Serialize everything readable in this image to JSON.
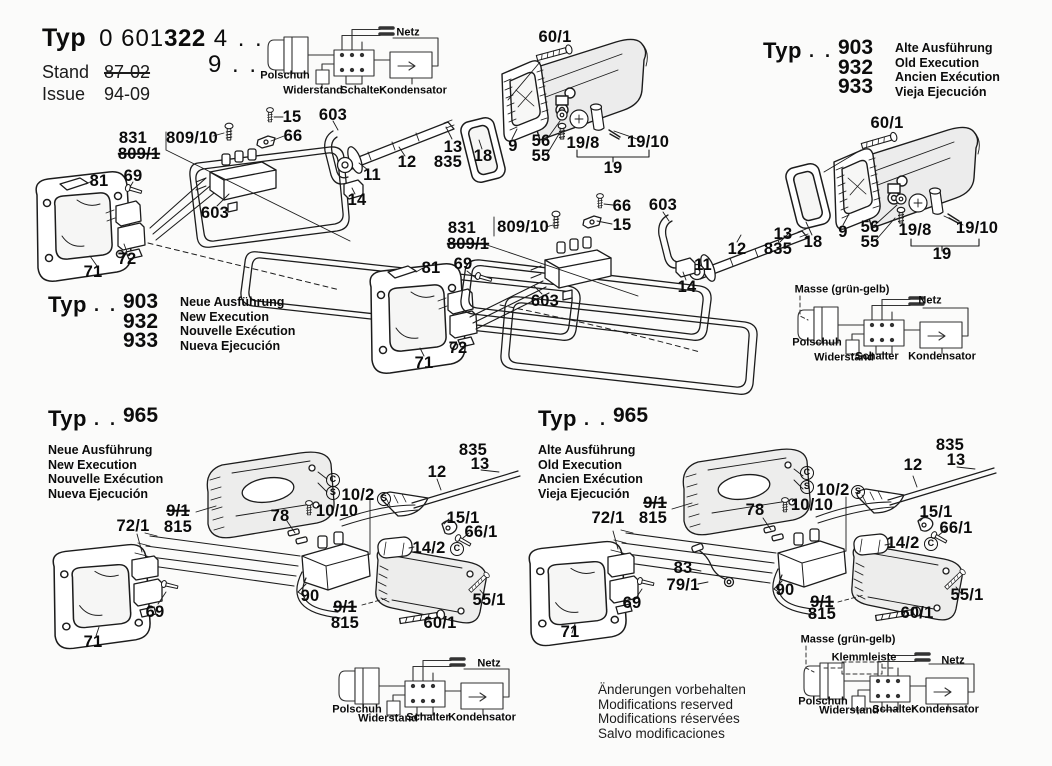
{
  "header": {
    "typ_label": "Typ",
    "code_prefix": "0 601",
    "code_bold": "322",
    "code_suffix": "4 . .",
    "code_line2": "9 . .",
    "stand_label": "Stand",
    "stand_value": "87-02",
    "issue_label": "Issue",
    "issue_value": "94-09"
  },
  "type_blocks": [
    {
      "x": 763,
      "y": 38,
      "typ": "Typ",
      "dots": ". .",
      "numbers": [
        "903",
        "932",
        "933"
      ],
      "langs": [
        "Alte Ausführung",
        "Old Execution",
        "Ancien Exécution",
        "Vieja Ejecución"
      ]
    },
    {
      "x": 48,
      "y": 292,
      "typ": "Typ",
      "dots": ". .",
      "numbers": [
        "903",
        "932",
        "933"
      ],
      "langs": [
        "Neue Ausführung",
        "New Execution",
        "Nouvelle Exécution",
        "Nueva Ejecución"
      ]
    },
    {
      "x": 48,
      "y": 406,
      "typ": "Typ",
      "dots": ". .",
      "numbers": [
        "965"
      ],
      "langs": [
        "Neue Ausführung",
        "New Execution",
        "Nouvelle Exécution",
        "Nueva Ejecución"
      ]
    },
    {
      "x": 538,
      "y": 406,
      "typ": "Typ",
      "dots": ". .",
      "numbers": [
        "965"
      ],
      "langs": [
        "Alte Ausführung",
        "Old Execution",
        "Ancien Exécution",
        "Vieja Ejecución"
      ]
    }
  ],
  "parts": {
    "top_left_assembly": [
      {
        "t": "831",
        "x": 133,
        "y": 138
      },
      {
        "t": "809/1",
        "x": 139,
        "y": 154,
        "k": "strike"
      },
      {
        "t": "809/10",
        "x": 192,
        "y": 138
      },
      {
        "t": "15",
        "x": 292,
        "y": 117
      },
      {
        "t": "66",
        "x": 293,
        "y": 136
      },
      {
        "t": "603",
        "x": 333,
        "y": 115
      },
      {
        "t": "81",
        "x": 99,
        "y": 181
      },
      {
        "t": "69",
        "x": 133,
        "y": 176
      },
      {
        "t": "603",
        "x": 215,
        "y": 213
      },
      {
        "t": "71",
        "x": 93,
        "y": 272
      },
      {
        "t": "72",
        "x": 127,
        "y": 259
      },
      {
        "t": "11",
        "x": 372,
        "y": 175
      },
      {
        "t": "14",
        "x": 357,
        "y": 200
      },
      {
        "t": "12",
        "x": 407,
        "y": 162
      },
      {
        "t": "13",
        "x": 453,
        "y": 147
      },
      {
        "t": "835",
        "x": 448,
        "y": 162
      },
      {
        "t": "18",
        "x": 483,
        "y": 156
      },
      {
        "t": "9",
        "x": 513,
        "y": 146
      },
      {
        "t": "56",
        "x": 541,
        "y": 141
      },
      {
        "t": "55",
        "x": 541,
        "y": 156
      },
      {
        "t": "19/8",
        "x": 583,
        "y": 143
      },
      {
        "t": "19/10",
        "x": 648,
        "y": 142
      },
      {
        "t": "19",
        "x": 613,
        "y": 168
      },
      {
        "t": "60/1",
        "x": 555,
        "y": 37
      }
    ],
    "top_right_assembly": [
      {
        "t": "60/1",
        "x": 887,
        "y": 123
      },
      {
        "t": "11",
        "x": 703,
        "y": 265
      },
      {
        "t": "12",
        "x": 737,
        "y": 249
      },
      {
        "t": "13",
        "x": 783,
        "y": 234
      },
      {
        "t": "835",
        "x": 778,
        "y": 249
      },
      {
        "t": "18",
        "x": 813,
        "y": 242
      },
      {
        "t": "9",
        "x": 843,
        "y": 232
      },
      {
        "t": "56",
        "x": 870,
        "y": 227
      },
      {
        "t": "55",
        "x": 870,
        "y": 242
      },
      {
        "t": "19/8",
        "x": 915,
        "y": 230
      },
      {
        "t": "19/10",
        "x": 977,
        "y": 228
      },
      {
        "t": "19",
        "x": 942,
        "y": 254
      }
    ],
    "middle_assembly": [
      {
        "t": "831",
        "x": 462,
        "y": 228
      },
      {
        "t": "809/1",
        "x": 468,
        "y": 244,
        "k": "strike"
      },
      {
        "t": "809/10",
        "x": 523,
        "y": 227
      },
      {
        "t": "66",
        "x": 622,
        "y": 206
      },
      {
        "t": "15",
        "x": 622,
        "y": 225
      },
      {
        "t": "603",
        "x": 663,
        "y": 205
      },
      {
        "t": "81",
        "x": 431,
        "y": 268
      },
      {
        "t": "69",
        "x": 463,
        "y": 264
      },
      {
        "t": "603",
        "x": 545,
        "y": 301
      },
      {
        "t": "14",
        "x": 687,
        "y": 287
      },
      {
        "t": "72",
        "x": 458,
        "y": 348
      },
      {
        "t": "71",
        "x": 424,
        "y": 363
      }
    ],
    "bottom_left_assembly": [
      {
        "t": "835",
        "x": 473,
        "y": 450
      },
      {
        "t": "13",
        "x": 480,
        "y": 464
      },
      {
        "t": "12",
        "x": 437,
        "y": 472
      },
      {
        "t": "C",
        "x": 333,
        "y": 480,
        "k": "circ"
      },
      {
        "t": "S",
        "x": 333,
        "y": 493,
        "k": "circ"
      },
      {
        "t": "10/2",
        "x": 358,
        "y": 495
      },
      {
        "t": "S",
        "x": 384,
        "y": 499,
        "k": "circ"
      },
      {
        "t": "10/10",
        "x": 337,
        "y": 511
      },
      {
        "t": "9/1",
        "x": 178,
        "y": 511,
        "k": "strike"
      },
      {
        "t": "815",
        "x": 178,
        "y": 527
      },
      {
        "t": "78",
        "x": 280,
        "y": 516
      },
      {
        "t": "72/1",
        "x": 133,
        "y": 526
      },
      {
        "t": "15/1",
        "x": 463,
        "y": 518
      },
      {
        "t": "66/1",
        "x": 481,
        "y": 532
      },
      {
        "t": "14/2",
        "x": 429,
        "y": 548
      },
      {
        "t": "C",
        "x": 457,
        "y": 549,
        "k": "circ"
      },
      {
        "t": "90",
        "x": 310,
        "y": 596
      },
      {
        "t": "9/1",
        "x": 345,
        "y": 607,
        "k": "strike"
      },
      {
        "t": "815",
        "x": 345,
        "y": 623
      },
      {
        "t": "60/1",
        "x": 440,
        "y": 623
      },
      {
        "t": "55/1",
        "x": 489,
        "y": 600
      },
      {
        "t": "69",
        "x": 155,
        "y": 612
      },
      {
        "t": "71",
        "x": 93,
        "y": 642
      }
    ],
    "bottom_right_assembly": [
      {
        "t": "835",
        "x": 950,
        "y": 445
      },
      {
        "t": "13",
        "x": 956,
        "y": 460
      },
      {
        "t": "12",
        "x": 913,
        "y": 465
      },
      {
        "t": "C",
        "x": 807,
        "y": 473,
        "k": "circ"
      },
      {
        "t": "S",
        "x": 807,
        "y": 487,
        "k": "circ"
      },
      {
        "t": "10/2",
        "x": 833,
        "y": 490
      },
      {
        "t": "S",
        "x": 858,
        "y": 492,
        "k": "circ"
      },
      {
        "t": "10/10",
        "x": 812,
        "y": 505
      },
      {
        "t": "9/1",
        "x": 655,
        "y": 503,
        "k": "strike"
      },
      {
        "t": "815",
        "x": 653,
        "y": 518
      },
      {
        "t": "78",
        "x": 755,
        "y": 510
      },
      {
        "t": "72/1",
        "x": 608,
        "y": 518
      },
      {
        "t": "15/1",
        "x": 936,
        "y": 512
      },
      {
        "t": "66/1",
        "x": 956,
        "y": 528
      },
      {
        "t": "14/2",
        "x": 903,
        "y": 543
      },
      {
        "t": "C",
        "x": 931,
        "y": 544,
        "k": "circ"
      },
      {
        "t": "83",
        "x": 683,
        "y": 568
      },
      {
        "t": "79/1",
        "x": 683,
        "y": 585
      },
      {
        "t": "90",
        "x": 785,
        "y": 590
      },
      {
        "t": "9/1",
        "x": 822,
        "y": 602,
        "k": "strike"
      },
      {
        "t": "815",
        "x": 822,
        "y": 614
      },
      {
        "t": "60/1",
        "x": 917,
        "y": 613
      },
      {
        "t": "55/1",
        "x": 967,
        "y": 595
      },
      {
        "t": "69",
        "x": 632,
        "y": 603
      },
      {
        "t": "71",
        "x": 570,
        "y": 632
      }
    ]
  },
  "wiring": [
    {
      "name": "top-left-schematic",
      "labels": [
        {
          "t": "Netz",
          "x": 408,
          "y": 33
        },
        {
          "t": "Polschuh",
          "x": 285,
          "y": 76
        },
        {
          "t": "Widerstand",
          "x": 313,
          "y": 91
        },
        {
          "t": "Schalter",
          "x": 362,
          "y": 91
        },
        {
          "t": "Kondensator",
          "x": 413,
          "y": 91
        }
      ]
    },
    {
      "name": "middle-right-schematic",
      "labels": [
        {
          "t": "Masse (grün-gelb)",
          "x": 842,
          "y": 290
        },
        {
          "t": "Netz",
          "x": 930,
          "y": 301
        },
        {
          "t": "Polschuh",
          "x": 817,
          "y": 343
        },
        {
          "t": "Widerstand",
          "x": 844,
          "y": 358
        },
        {
          "t": "Schalter",
          "x": 877,
          "y": 357
        },
        {
          "t": "Kondensator",
          "x": 942,
          "y": 357
        }
      ]
    },
    {
      "name": "bottom-middle-schematic",
      "labels": [
        {
          "t": "Netz",
          "x": 489,
          "y": 664
        },
        {
          "t": "Polschuh",
          "x": 357,
          "y": 710
        },
        {
          "t": "Widerstand",
          "x": 388,
          "y": 719
        },
        {
          "t": "Schalter",
          "x": 428,
          "y": 718
        },
        {
          "t": "Kondensator",
          "x": 482,
          "y": 718
        }
      ]
    },
    {
      "name": "bottom-right-schematic",
      "labels": [
        {
          "t": "Masse (grün-gelb)",
          "x": 848,
          "y": 640
        },
        {
          "t": "Klemmleiste",
          "x": 864,
          "y": 658
        },
        {
          "t": "Netz",
          "x": 953,
          "y": 661
        },
        {
          "t": "Polschuh",
          "x": 823,
          "y": 702
        },
        {
          "t": "Widerstand",
          "x": 849,
          "y": 711
        },
        {
          "t": "Schalter",
          "x": 894,
          "y": 710
        },
        {
          "t": "Kondensator",
          "x": 945,
          "y": 710
        }
      ]
    }
  ],
  "notes": [
    "Änderungen vorbehalten",
    "Modifications reserved",
    "Modifications réservées",
    "Salvo modificaciones"
  ]
}
